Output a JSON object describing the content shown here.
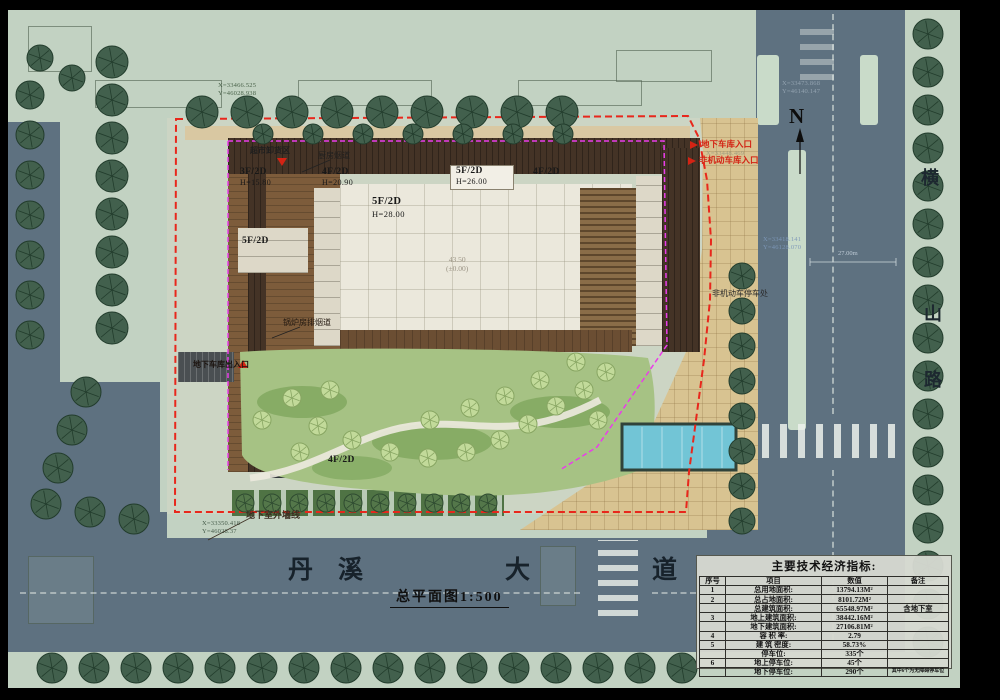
{
  "drawing": {
    "title": "总平面图1:500",
    "compass_label": "N"
  },
  "roads": {
    "bottom_name": "丹溪大道",
    "bottom_name_chars": [
      "丹",
      "溪",
      "大",
      "道"
    ],
    "right_name": "横山路",
    "right_name_chars": [
      "横",
      "山",
      "路"
    ]
  },
  "labels": {
    "unload_area": "超市卸货区",
    "kitchen_flue": "厨房烟道",
    "boiler_flue": "锅炉房排烟道",
    "garage_exit": "地下车库出入口",
    "garage_entrance": "地下车库入口",
    "bike_entrance": "非机动车库入口",
    "bike_parking": "非机动车停车处",
    "basement_wall": "地下室外墙线"
  },
  "building_labels": {
    "b1": {
      "name": "3F/2D",
      "height": "H=15.80"
    },
    "b2": {
      "name": "4F/2D",
      "height": "H=20.90"
    },
    "b3": {
      "name": "5F/2D",
      "height": "H=26.00"
    },
    "b4": {
      "name": "4F/2D",
      "height": ""
    },
    "b5": {
      "name": "5F/2D",
      "height": "H=28.00"
    },
    "b6": {
      "name": "5F/2D",
      "height": ""
    },
    "b7": {
      "name": "4F/2D",
      "height": ""
    },
    "level": {
      "value": "43.50",
      "datum": "(±0.00)"
    }
  },
  "coordinates": {
    "top_left": {
      "x": "X=33466.525",
      "y": "Y=46028.938"
    },
    "top_right": {
      "x": "X=33473.868",
      "y": "Y=46140.147"
    },
    "right_mid": {
      "x": "X=33418.141",
      "y": "Y=46128.070"
    },
    "bottom_left": {
      "x": "X=33350.418",
      "y": "Y=46028.37"
    },
    "entrance": {
      "x": "X=33448.469"
    }
  },
  "dimensions": {
    "road_width": "27.00m"
  },
  "table": {
    "title": "主要技术经济指标:",
    "headers": [
      "序号",
      "项目",
      "数值",
      "备注"
    ],
    "rows": [
      [
        "1",
        "总用地面积:",
        "13794.13M²",
        ""
      ],
      [
        "2",
        "总占地面积:",
        "8101.72M²",
        ""
      ],
      [
        "",
        "总建筑面积:",
        "65548.97M²",
        "含地下室"
      ],
      [
        "3",
        "地上建筑面积:",
        "38442.16M²",
        ""
      ],
      [
        "",
        "地下建筑面积:",
        "27106.81M²",
        ""
      ],
      [
        "4",
        "容 积 率:",
        "2.79",
        ""
      ],
      [
        "5",
        "建 筑 密度:",
        "58.73%",
        ""
      ],
      [
        "",
        "停车位:",
        "335个",
        ""
      ],
      [
        "6",
        "地上停车位:",
        "45个",
        ""
      ],
      [
        "",
        "地下停车位:",
        "290个",
        "其中6个为无障碍停车位"
      ]
    ]
  },
  "colors": {
    "boundary_red": "#e8271c",
    "setback_magenta": "#ea3cea",
    "road": "#5e7180",
    "sidewalk": "#c2d2c2",
    "plaza": "#d8c391",
    "lawn": "#a6c284",
    "pool": "#72c5d6"
  }
}
